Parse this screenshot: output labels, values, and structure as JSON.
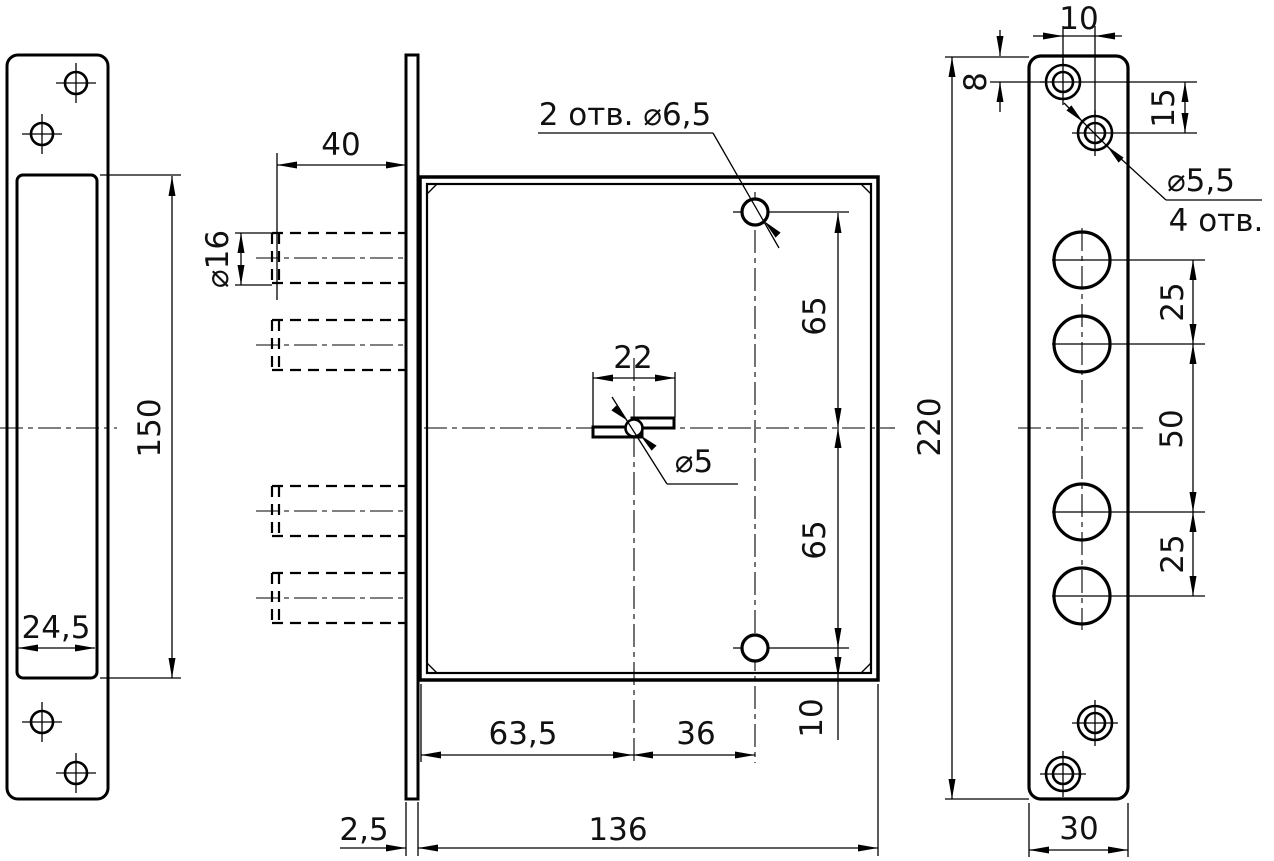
{
  "drawing": {
    "background": "#ffffff",
    "line_color": "#000000",
    "text_color": "#111111"
  },
  "dims": {
    "d40": "40",
    "d150": "150",
    "d24_5": "24,5",
    "d16": "⌀16",
    "holes2": "2 отв. ⌀6,5",
    "d22": "22",
    "d5": "⌀5",
    "d65_top": "65",
    "d65_bot": "65",
    "d10_body": "10",
    "d63_5": "63,5",
    "d36": "36",
    "d2_5": "2,5",
    "d136": "136",
    "d10_plate": "10",
    "d8": "8",
    "d15": "15",
    "d5_5": "⌀5,5",
    "holes4": "4 отв.",
    "d25_top": "25",
    "d50": "50",
    "d25_bot": "25",
    "d220": "220",
    "d30": "30"
  }
}
